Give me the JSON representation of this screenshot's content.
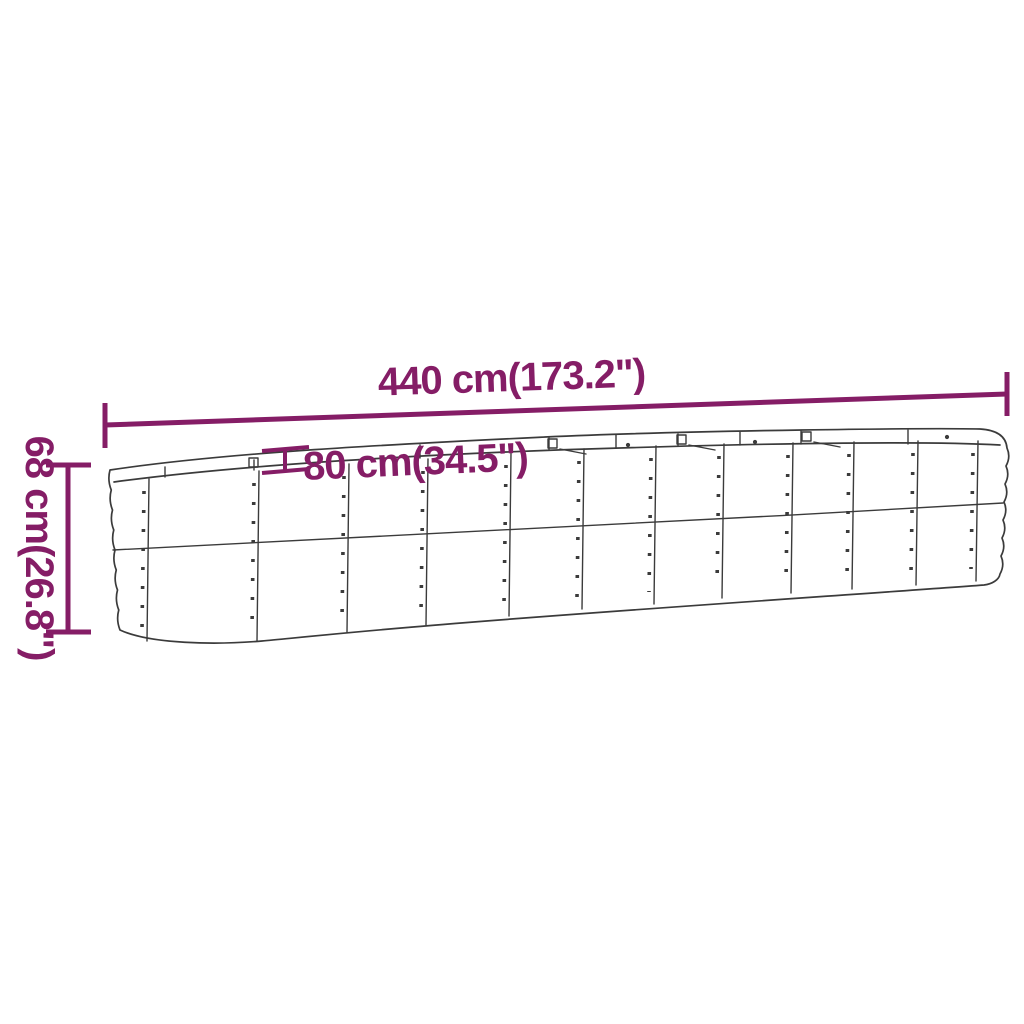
{
  "diagram": {
    "description": "Line drawing of an oval metal raised garden bed planter with dimension annotations",
    "colors": {
      "dimension_accent": "#851d66",
      "line_art": "#3b3b3b",
      "background": "#ffffff"
    },
    "dimensions": {
      "length": {
        "cm": "440",
        "inch": "173.2",
        "label": "440 cm(173.2\")"
      },
      "depth": {
        "cm": "80",
        "inch": "34.5",
        "label": "80 cm(34.5\")"
      },
      "height": {
        "cm": "68",
        "inch": "26.8",
        "label": "68 cm(26.8\")"
      }
    }
  }
}
